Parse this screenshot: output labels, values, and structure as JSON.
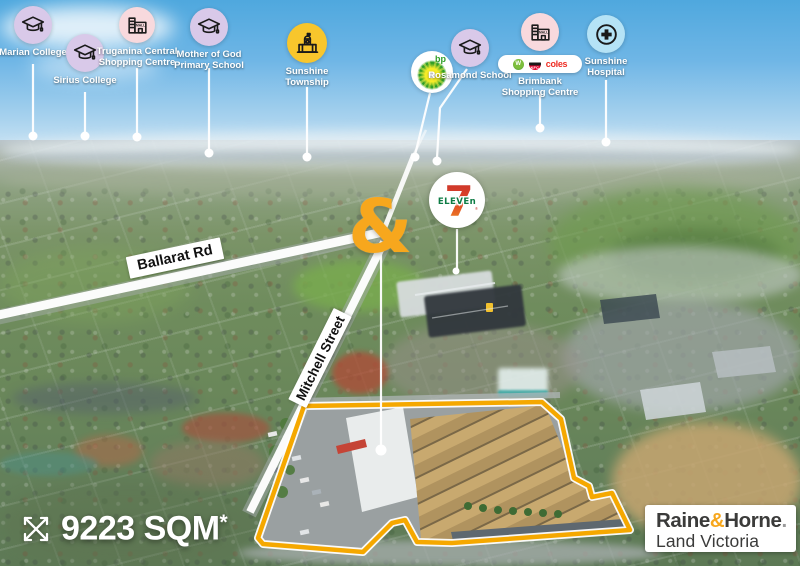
{
  "pins": {
    "marian": {
      "label": "Marian College"
    },
    "sirius": {
      "label": "Sirius College"
    },
    "truganina": {
      "line1": "Truganina Central",
      "line2": "Shopping Centre"
    },
    "mother_of_god": {
      "line1": "Mother of God",
      "line2": "Primary School"
    },
    "sunshine_township": {
      "line1": "Sunshine",
      "line2": "Township"
    },
    "bp": {
      "label": "bp"
    },
    "rosamond": {
      "label": "Rosamond School"
    },
    "brimbank": {
      "line1": "Brimbank",
      "line2": "Shopping Centre"
    },
    "sunshine_hospital": {
      "line1": "Sunshine",
      "line2": "Hospital"
    }
  },
  "retail_logos": {
    "woolworths": "W",
    "kfc": "KFC",
    "coles": "coles"
  },
  "icon_texts": {
    "mall": "MALL"
  },
  "seven_eleven": {
    "seven": "7",
    "eleven": "ELEVEn",
    "reg": "®"
  },
  "marker": {
    "symbol": "&"
  },
  "roads": {
    "ballarat": "Ballarat Rd",
    "mitchell": "Mitchell Street"
  },
  "area": {
    "value": "9223 SQM",
    "asterisk": "*"
  },
  "brand": {
    "raine": "Raine",
    "amp": "&",
    "horne": "Horne",
    "dot": ".",
    "region": "Land Victoria"
  },
  "colors": {
    "accent_yellow": "#F7A71D",
    "property_outline": "#F5A800",
    "school_pin": "#D9C9E9",
    "shopping_pin": "#F8D9DD",
    "township_pin": "#F8C62C",
    "hospital_pin": "#B5E3F6",
    "bp_green": "#2F9E26",
    "eleven_green": "#0E7C45",
    "seven_red": "#D33A2F",
    "coles_red": "#EE2E24"
  }
}
